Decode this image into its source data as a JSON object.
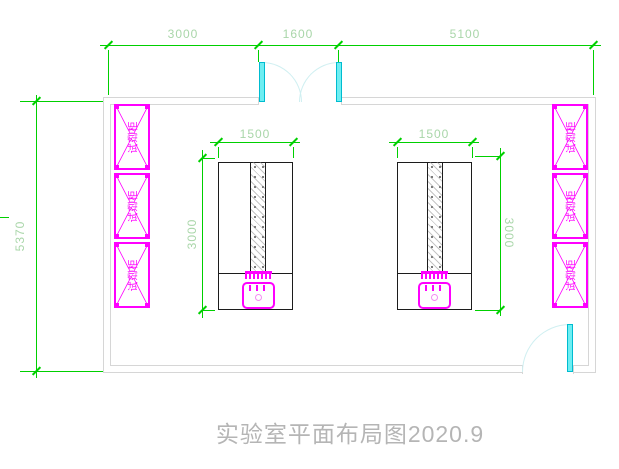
{
  "drawing": {
    "title": "实验室平面布局图2020.9"
  },
  "dimensions": {
    "top_left_span": "3000",
    "top_door_span": "1600",
    "top_right_span": "5100",
    "left_wall_height": "5370",
    "left_bench_width": "1500",
    "left_bench_height": "3000",
    "right_bench_width": "1500",
    "right_bench_height": "3000"
  },
  "labels": {
    "reagent_cabinet": "试剂柜"
  },
  "colors": {
    "dimension_line": "#00d000",
    "dimension_text": "#a9d6a9",
    "cabinet_magenta": "#ff00ff",
    "door_cyan": "#6eeef2",
    "door_arc": "#cfeff1",
    "wall_gray": "#d6d6d6",
    "bench_outline": "#1c1c1c",
    "title_gray": "#b5b5b5"
  }
}
